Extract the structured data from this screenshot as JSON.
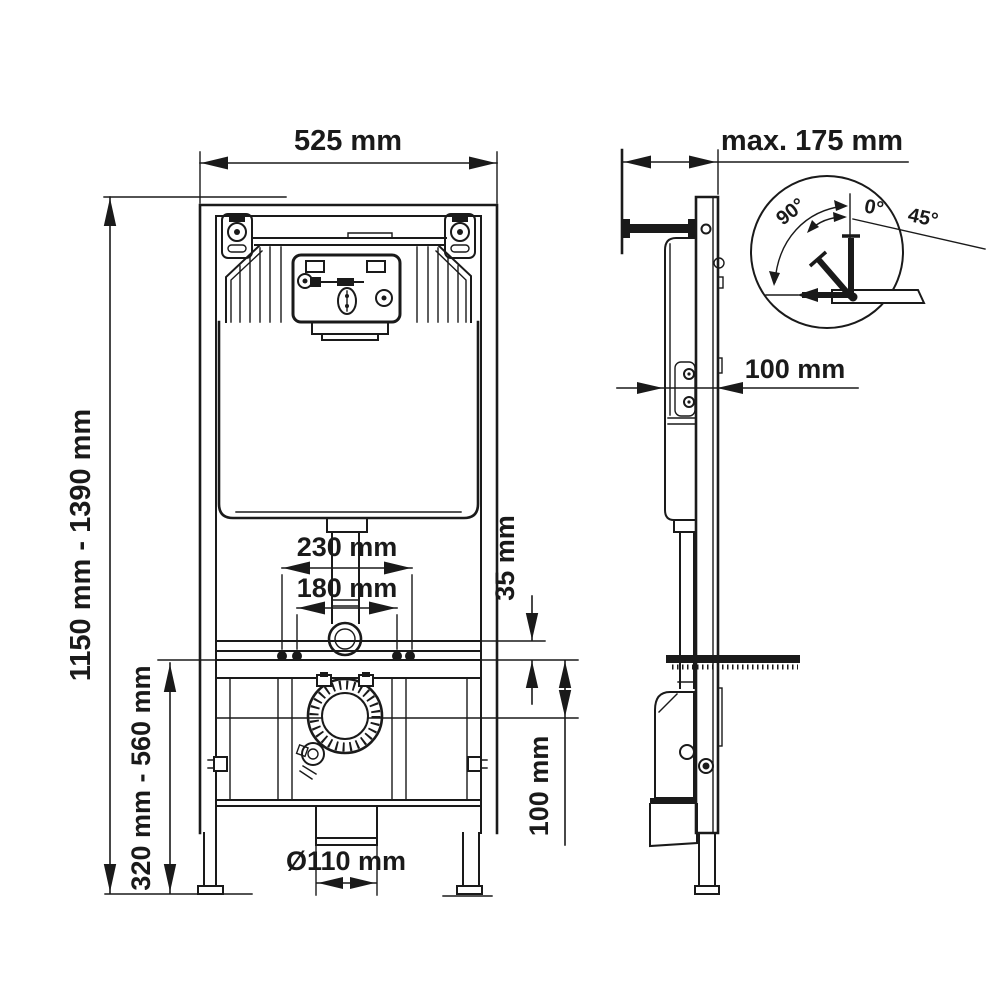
{
  "front_view": {
    "width_dim": "525 mm",
    "height_dim": "1150 mm - 1390 mm",
    "lower_height_dim": "320 mm - 560 mm",
    "upper_spacing_dim": "230 mm",
    "inner_spacing_dim": "180 mm",
    "rail_offset_dim": "35 mm",
    "drain_offset_dim": "100 mm",
    "outlet_diameter_dim": "Ø110 mm"
  },
  "side_view": {
    "depth_dim": "max. 175 mm",
    "wall_offset_dim": "100 mm"
  },
  "angle_detail": {
    "sweep_angle": "90°",
    "range_min": "0°",
    "range_max": "45°"
  }
}
